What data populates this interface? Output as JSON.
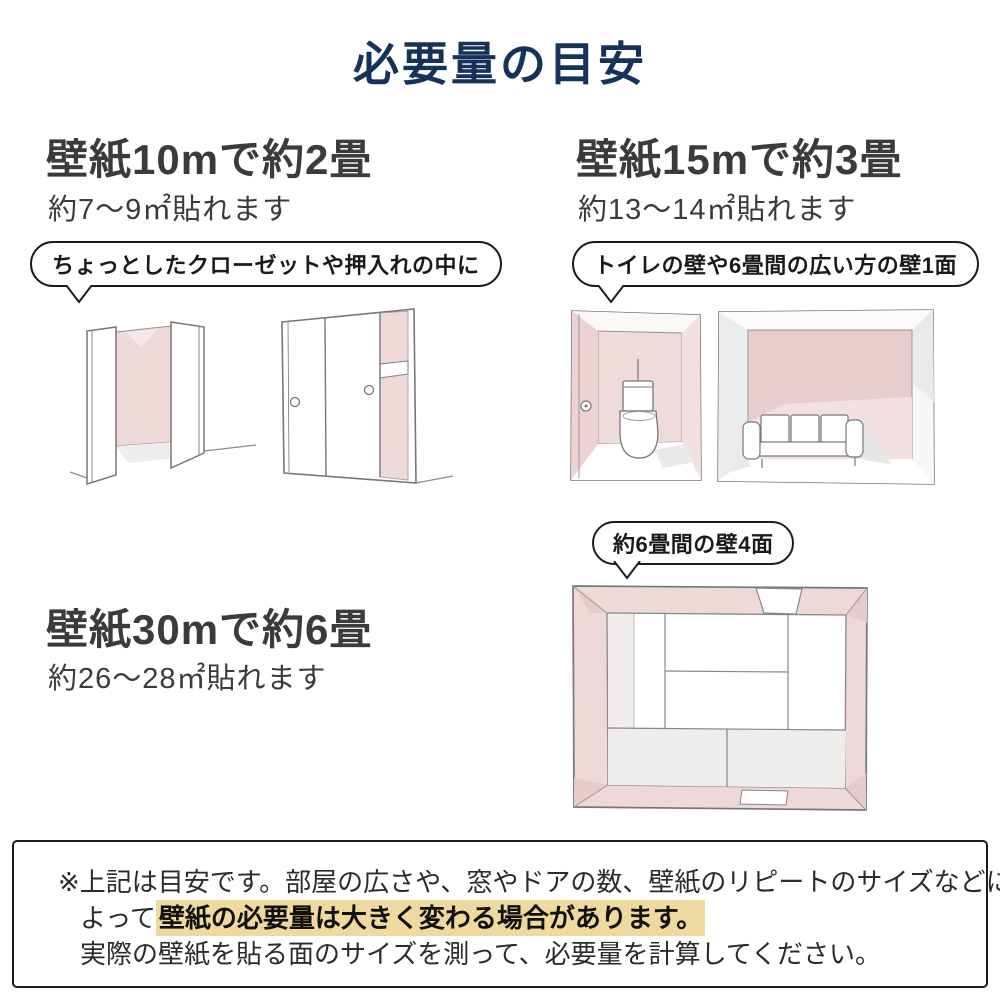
{
  "title": "必要量の目安",
  "colors": {
    "accent_navy": "#17325a",
    "wall_pink": "#efd8d8",
    "wall_pink_dark": "#e8cccc",
    "wall_pink_light": "#f4e4e4",
    "shadow_gray": "#ececec",
    "highlight_yellow": "#eeda9e"
  },
  "sections": [
    {
      "heading": "壁紙10mで約2畳",
      "subtext": "約7〜9㎡貼れます",
      "bubble": "ちょっとしたクローゼットや押入れの中に",
      "illustrations": [
        "closet-open-doors",
        "closet-sliding-doors"
      ]
    },
    {
      "heading": "壁紙15mで約3畳",
      "subtext": "約13〜14㎡貼れます",
      "bubble": "トイレの壁や6畳間の広い方の壁1面",
      "illustrations": [
        "toilet-room",
        "living-room-sofa"
      ]
    },
    {
      "heading": "壁紙30mで約6畳",
      "subtext": "約26〜28㎡貼れます",
      "bubble": "約6畳間の壁4面",
      "illustrations": [
        "six-tatami-room-top-view"
      ]
    }
  ],
  "note": {
    "line1": "※上記は目安です。部屋の広さや、窓やドアの数、壁紙のリピートのサイズなどに",
    "line2_prefix": "よって",
    "line2_highlight": "壁紙の必要量は大きく変わる場合があります。",
    "line3": "実際の壁紙を貼る面のサイズを測って、必要量を計算してください。"
  }
}
